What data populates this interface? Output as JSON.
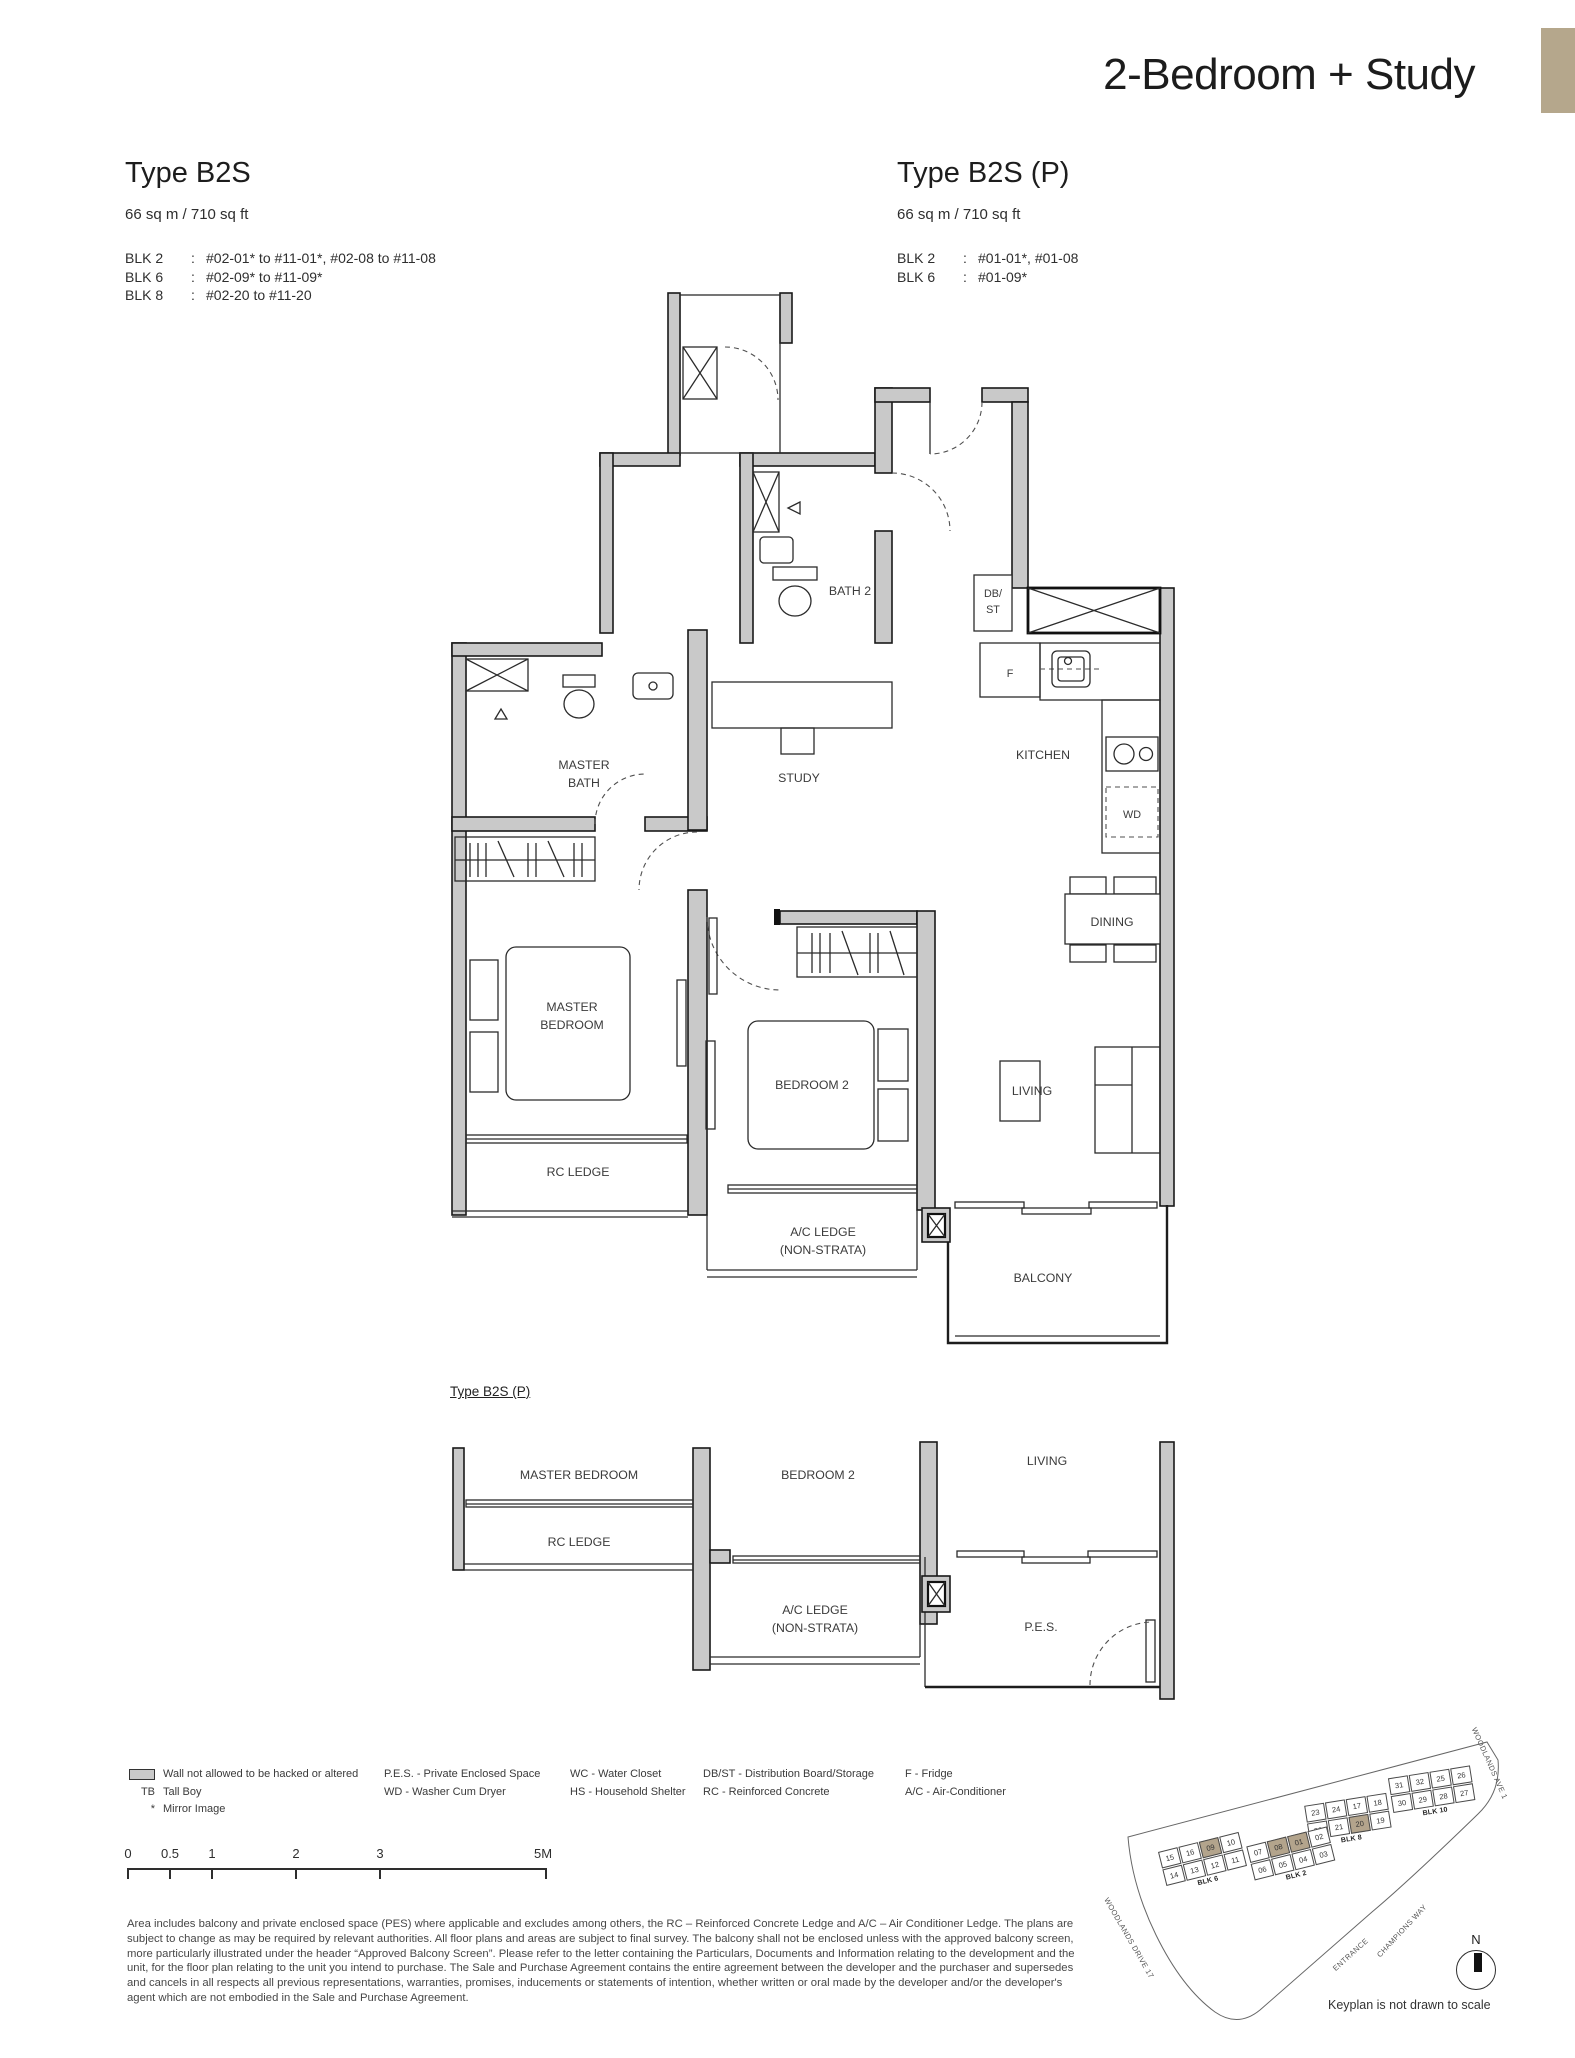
{
  "page": {
    "title": "2-Bedroom + Study",
    "corner_tab_color": "#b5a78c",
    "highlight_color": "#b3a48c"
  },
  "type_left": {
    "name": "Type B2S",
    "area": "66 sq m /  710 sq ft",
    "blocks": [
      {
        "blk": "BLK 2",
        "sep": ":",
        "units": "#02-01* to #11-01*, #02-08 to #11-08"
      },
      {
        "blk": "BLK 6",
        "sep": ":",
        "units": "#02-09* to #11-09*"
      },
      {
        "blk": "BLK 8",
        "sep": ":",
        "units": "#02-20 to #11-20"
      }
    ]
  },
  "type_right": {
    "name": "Type B2S (P)",
    "area": "66 sq m /  710 sq ft",
    "blocks": [
      {
        "blk": "BLK 2",
        "sep": ":",
        "units": "#01-01*, #01-08"
      },
      {
        "blk": "BLK 6",
        "sep": ":",
        "units": "#01-09*"
      }
    ]
  },
  "plan_main": {
    "bath2": "BATH 2",
    "dbst_1": "DB/",
    "dbst_2": "ST",
    "fridge": "F",
    "master_bath_1": "MASTER",
    "master_bath_2": "BATH",
    "study": "STUDY",
    "kitchen": "KITCHEN",
    "wd": "WD",
    "dining": "DINING",
    "master_bedroom_1": "MASTER",
    "master_bedroom_2": "BEDROOM",
    "bedroom2": "BEDROOM 2",
    "living": "LIVING",
    "rc_ledge": "RC LEDGE",
    "ac_ledge_1": "A/C LEDGE",
    "ac_ledge_2": "(NON-STRATA)",
    "balcony": "BALCONY"
  },
  "plan_p": {
    "heading": "Type B2S (P)",
    "master_bedroom": "MASTER BEDROOM",
    "rc_ledge": "RC LEDGE",
    "bedroom2": "BEDROOM 2",
    "ac_ledge_1": "A/C LEDGE",
    "ac_ledge_2": "(NON-STRATA)",
    "living": "LIVING",
    "pes": "P.E.S."
  },
  "legend": {
    "wall_label": "Wall not allowed to be hacked or altered",
    "tb_abbr": "TB",
    "tb_label": "Tall Boy",
    "mirror_abbr": "*",
    "mirror_label": "Mirror Image",
    "col2": [
      "P.E.S. - Private Enclosed Space",
      "WD - Washer Cum Dryer"
    ],
    "col3": [
      "WC - Water Closet",
      "HS - Household Shelter"
    ],
    "col4": [
      "DB/ST - Distribution Board/Storage",
      "RC - Reinforced Concrete"
    ],
    "col5": [
      "F - Fridge",
      "A/C - Air-Conditioner"
    ]
  },
  "scalebar": {
    "ticks": [
      "0",
      "0.5",
      "1",
      "2",
      "3",
      "5M"
    ]
  },
  "disclaimer": "Area includes balcony and private enclosed space (PES) where applicable and excludes among others, the RC – Reinforced Concrete Ledge and A/C – Air Conditioner Ledge. The plans are subject to change as may be required by relevant authorities. All floor plans and areas are subject to final survey. The balcony shall not be enclosed unless with the approved balcony screen, more particularly illustrated under the header “Approved Balcony Screen”. Please refer to the letter containing the Particulars, Documents and Information relating to the development and the unit, for the floor plan relating to the unit you intend to purchase. The Sale and Purchase Agreement contains the entire agreement between the developer and the purchaser and supersedes and cancels in all respects all previous representations, warranties, promises, inducements or statements of intention, whether written or oral made by the developer and/or the developer's agent which are not embodied in the Sale and Purchase Agreement.",
  "keyplan": {
    "caption": "Keyplan is not drawn to scale",
    "north": "N",
    "streets": {
      "top_right": "WOODLANDS AVE 1",
      "left": "WOODLANDS DRIVE 17",
      "bottom_right": "CHAMPIONS WAY",
      "entrance": "ENTRANCE"
    },
    "blk8": {
      "label": "BLK 8",
      "top": [
        {
          "n": "23"
        },
        {
          "n": "24"
        },
        {
          "n": "17"
        },
        {
          "n": "18"
        }
      ],
      "bottom": [
        {
          "n": "22"
        },
        {
          "n": "21"
        },
        {
          "n": "20",
          "hl": true
        },
        {
          "n": "19"
        }
      ]
    },
    "blk10": {
      "label": "BLK 10",
      "top": [
        {
          "n": "31"
        },
        {
          "n": "32"
        },
        {
          "n": "25"
        },
        {
          "n": "26"
        }
      ],
      "bottom": [
        {
          "n": "30"
        },
        {
          "n": "29"
        },
        {
          "n": "28"
        },
        {
          "n": "27"
        }
      ]
    },
    "blk6": {
      "label": "BLK 6",
      "top": [
        {
          "n": "15"
        },
        {
          "n": "16"
        },
        {
          "n": "09",
          "hl": true
        },
        {
          "n": "10"
        }
      ],
      "bottom": [
        {
          "n": "14"
        },
        {
          "n": "13"
        },
        {
          "n": "12"
        },
        {
          "n": "11"
        }
      ]
    },
    "blk2": {
      "label": "BLK 2",
      "top": [
        {
          "n": "07"
        },
        {
          "n": "08",
          "hl": true
        },
        {
          "n": "01",
          "hl": true
        },
        {
          "n": "02"
        }
      ],
      "bottom": [
        {
          "n": "06"
        },
        {
          "n": "05"
        },
        {
          "n": "04"
        },
        {
          "n": "03"
        }
      ]
    }
  }
}
